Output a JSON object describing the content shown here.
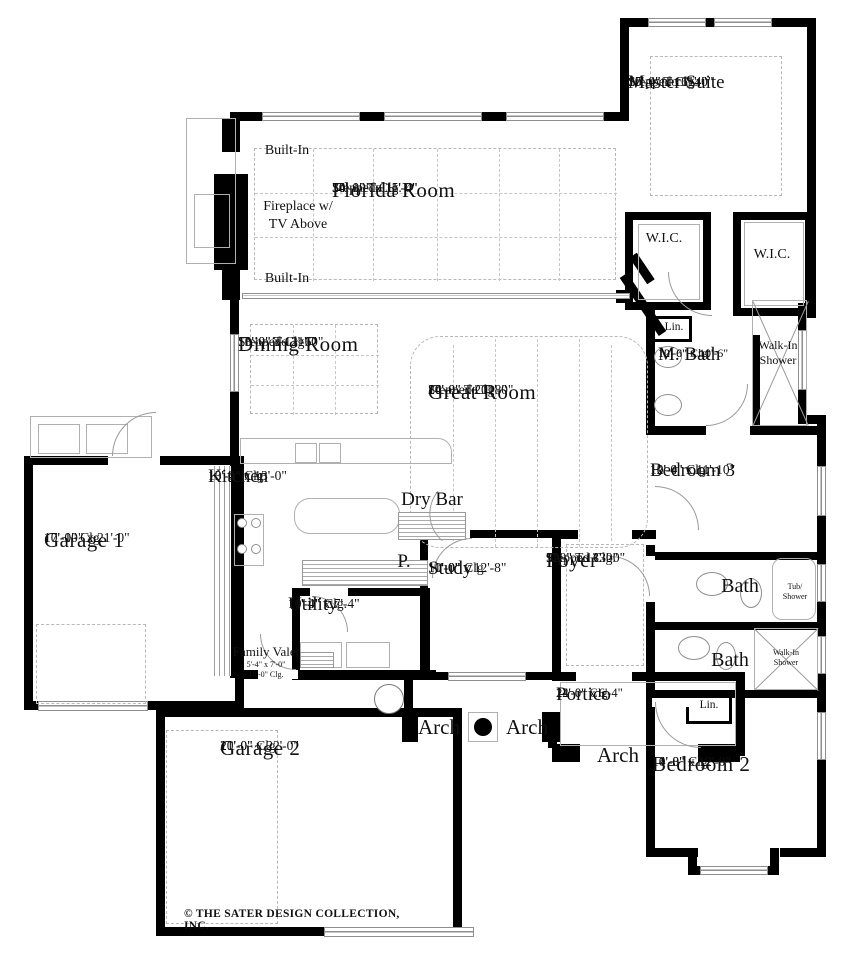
{
  "copyright": "© THE SATER DESIGN COLLECTION, INC.",
  "rooms": {
    "master_suite": {
      "name": "Master Suite",
      "dims": "15'-4\" x 16'-4\"",
      "clg1": "10'-0\" To 11'-0\"",
      "clg2": "Stepped Clg."
    },
    "florida_room": {
      "name": "Florida Room",
      "dims": "34'-10\" x 15'-4\"",
      "clg1": "10'-0\" To 11'-0\"",
      "clg2": "Stepped Clg."
    },
    "dining_room": {
      "name": "Dining Room",
      "dims": "13'-0\" x 12'-6\"",
      "clg1": "10'-0\" To 11'-0\"",
      "clg2": "Stepped Clg."
    },
    "great_room": {
      "name": "Great Room",
      "dims": "24'-8\" x 20'-8\"",
      "clg1": "10'-0\" To 11'-0\"",
      "clg2": "Stepped Clg."
    },
    "kitchen": {
      "name": "Kitchen",
      "dims": "13'-4\" x 13'-0\"",
      "clg1": "10'-0\" Clg."
    },
    "garage1": {
      "name": "Garage 1",
      "dims": "17'-10\" x 21'-0\"",
      "clg1": "10'-0\" Clg."
    },
    "study": {
      "name": "Study",
      "dims": "11'-0\" x 12'-8\"",
      "clg1": "10'-0\" Clg."
    },
    "foyer": {
      "name": "Foyer",
      "dims": "9'-0\" x 13'-0\"",
      "clg1": "12'-\" To 13'-0\"",
      "clg2": "Stepped Clg."
    },
    "utility": {
      "name": "Utility",
      "dims": "11'-4\" x 7'-4\"",
      "clg1": "10'-0\" Clg."
    },
    "family_valet": {
      "name": "Family Valet",
      "dims": "5'-4\" x 7'-0\"",
      "clg1": "10'-0\" Clg."
    },
    "m_bath": {
      "name": "M. Bath",
      "dims": "12'-6\" x 10'-6\"",
      "clg1": "10'-0\" Clg."
    },
    "bedroom3": {
      "name": "Bedroom 3",
      "dims": "12'-4\" x 11'-10\"",
      "clg1": "10'-0\" Clg."
    },
    "bedroom2": {
      "name": "Bedroom 2",
      "dims": "14'-8\" x 12'-0\"",
      "clg1": "10'-0\" Clg."
    },
    "portico": {
      "name": "Portico",
      "dims": "22'-0\" x 6'-4\"",
      "clg1": "14'-0\" Clg."
    },
    "garage2": {
      "name": "Garage 2",
      "dims": "21'-0\" x 22'-0\"",
      "clg1": "10'-0\" Clg."
    }
  },
  "labels": {
    "built_in_top": "Built-In",
    "built_in_bottom": "Built-In",
    "fireplace": "Fireplace w/\nTV Above",
    "wic_left": "W.I.C.",
    "wic_right": "W.I.C.",
    "walk_in_shower_master": "Walk-In\nShower",
    "lin_master": "Lin.",
    "dry_bar": "Dry Bar",
    "pantry": "P.",
    "bath_upper": "Bath",
    "bath_lower": "Bath",
    "tub_shower": "Tub/\nShower",
    "walk_in_shower_bed2": "Walk-In\nShower",
    "lin_bed2": "Lin.",
    "arch_left": "Arch",
    "arch_right": "Arch",
    "arch_portico": "Arch"
  }
}
